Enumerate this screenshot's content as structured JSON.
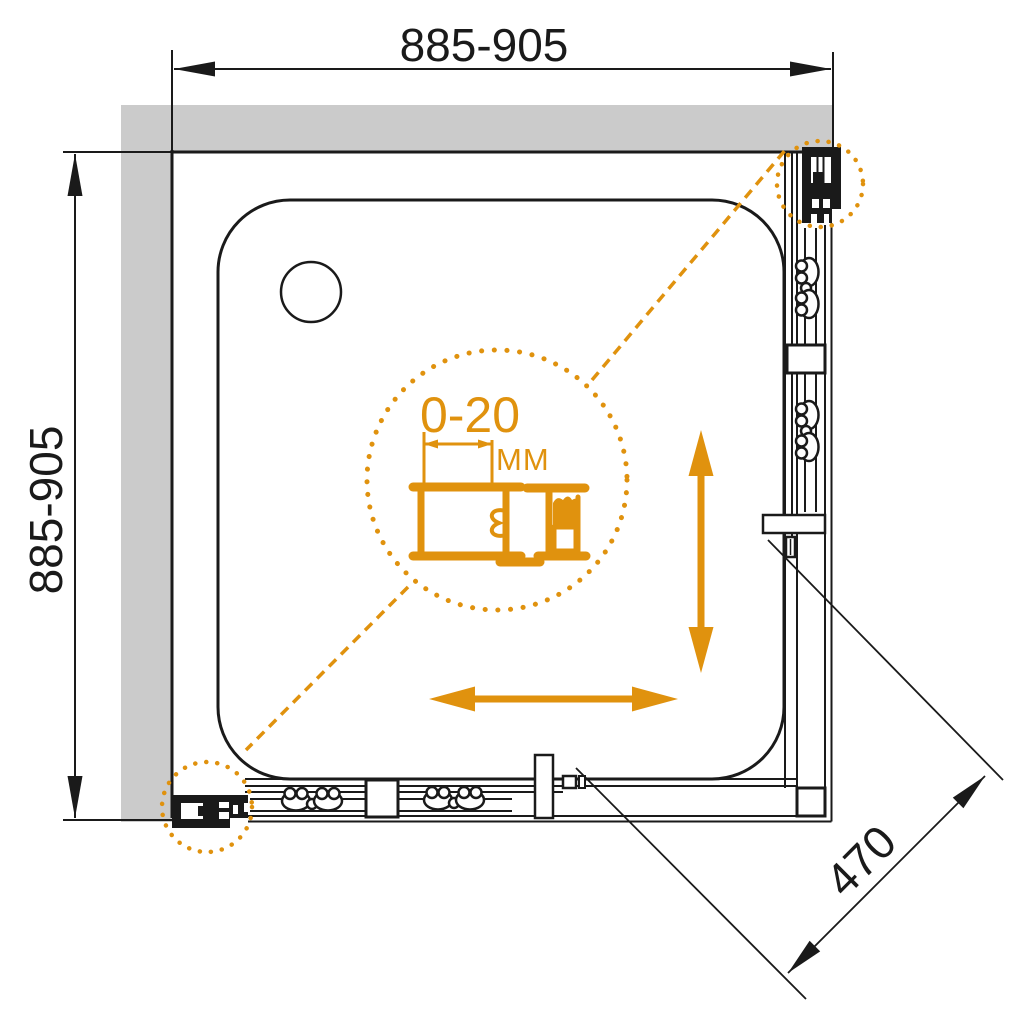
{
  "diagram": {
    "type": "shower-enclosure-installation-drawing",
    "dimensions": {
      "width": {
        "label": "885-905"
      },
      "height": {
        "label": "885-905"
      },
      "entry_opening": {
        "label": "470"
      },
      "adjustment": {
        "value": "0-20",
        "unit": "MM"
      }
    },
    "colors": {
      "accent_orange": "#E0920E",
      "line_black": "#1A1A1A",
      "wall_gray": "#CBCBCB",
      "background": "#FFFFFF"
    }
  }
}
